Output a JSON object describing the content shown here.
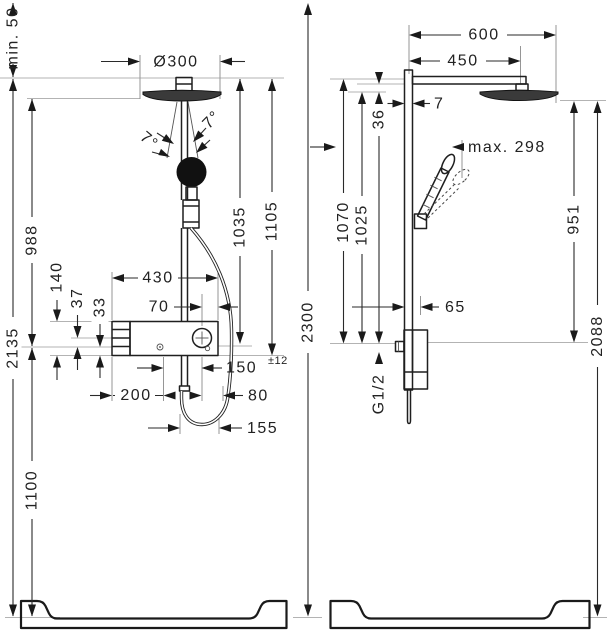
{
  "drawing": {
    "front_view": {
      "dims": {
        "min_clearance": "min. 50",
        "head_diameter": "Ø300",
        "angle_left": "7°",
        "angle_right": "7°",
        "height_988": "988",
        "height_2135": "2135",
        "height_1100": "1100",
        "height_1035": "1035",
        "height_1105": "1105",
        "valve_140": "140",
        "offset_37": "37",
        "offset_33": "33",
        "width_430": "430",
        "offset_70": "70",
        "offset_150": "150",
        "tolerance_150": "±12",
        "width_200": "200",
        "offset_80": "80",
        "loop_155": "155"
      }
    },
    "side_view": {
      "dims": {
        "arm_600": "600",
        "arm_450": "450",
        "bar_7": "7",
        "offset_36": "36",
        "max_reach": "max. 298",
        "height_1070": "1070",
        "height_1025": "1025",
        "height_2300": "2300",
        "offset_65": "65",
        "thread": "G1/2",
        "height_951": "951",
        "height_2088": "2088"
      }
    }
  }
}
